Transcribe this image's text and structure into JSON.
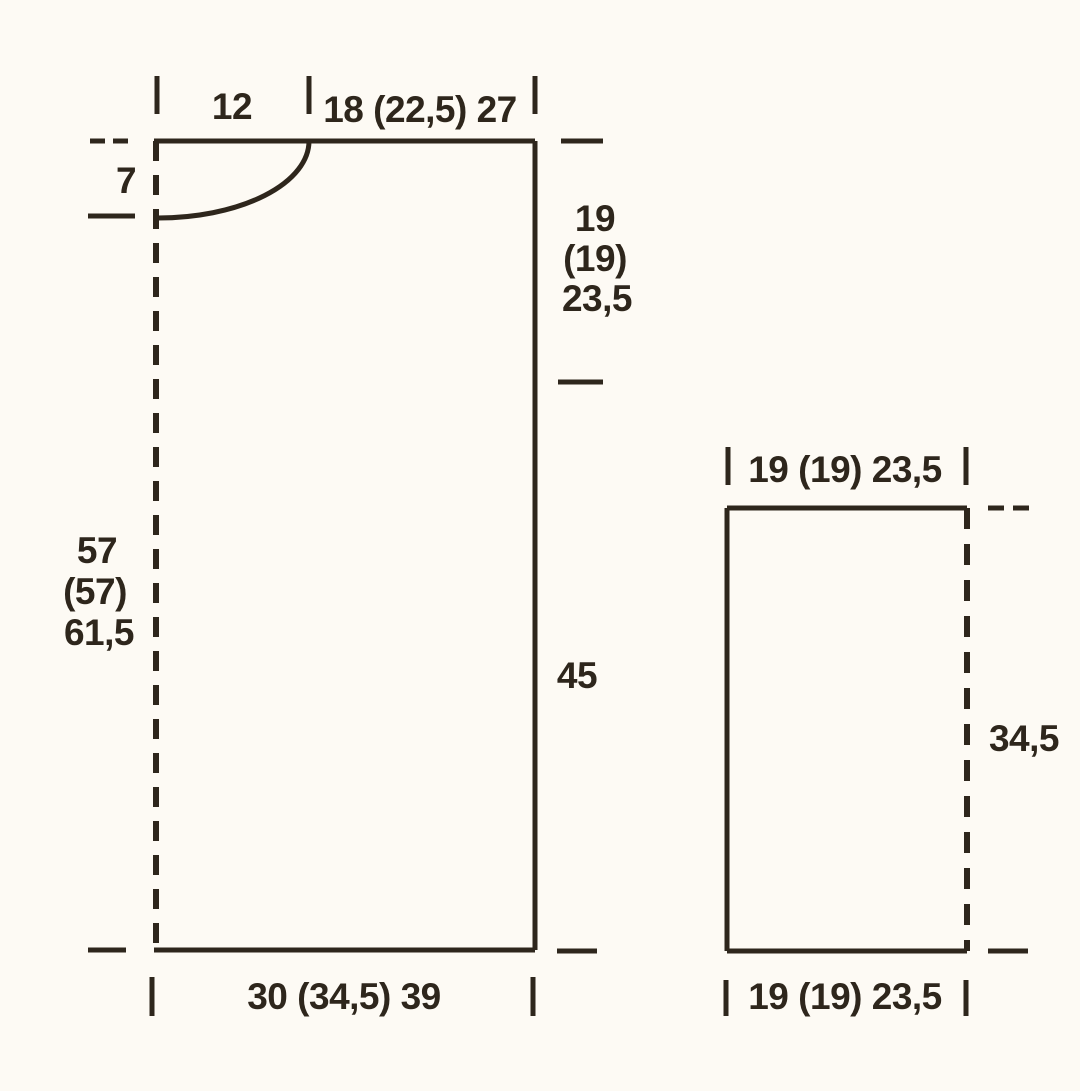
{
  "colors": {
    "paper": "#fdfaf4",
    "ink": "#2e261c"
  },
  "piece_front_back": {
    "neck_width": "12",
    "shoulder_width": "18 (22,5) 27",
    "neck_depth": "7",
    "armhole_depth_line1": "19",
    "armhole_depth_line2": "(19)",
    "armhole_depth_line3": "23,5",
    "side_seam_length": "45",
    "total_length_line1": "57",
    "total_length_line2": "(57)",
    "total_length_line3": "61,5",
    "hem_width": "30 (34,5) 39"
  },
  "piece_sleeve": {
    "top_width": "19 (19) 23,5",
    "seam_length": "34,5",
    "bottom_width": "19 (19) 23,5"
  }
}
